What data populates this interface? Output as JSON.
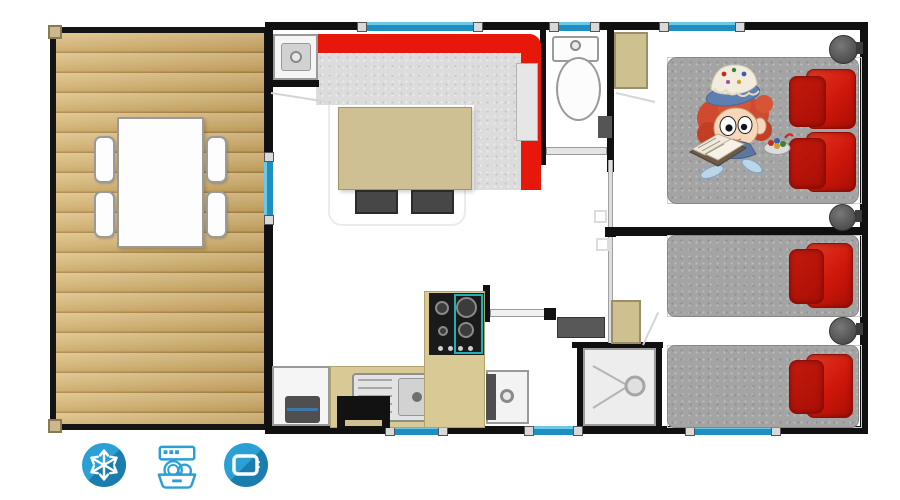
{
  "page": {
    "type": "mobile-home-floor-plan",
    "background": "#ffffff"
  },
  "amenities": [
    {
      "id": "air-conditioning",
      "icon": "snowflake-icon",
      "label": "air conditioning"
    },
    {
      "id": "dishwasher",
      "icon": "dishwasher-icon",
      "label": "dishwasher"
    },
    {
      "id": "television",
      "icon": "tv-icon",
      "label": "television"
    }
  ],
  "palette": {
    "wall": "#101010",
    "window_glass": "#2aa3d6",
    "deck_wood": "#d2b274",
    "sofa_red": "#e8170c",
    "pillow_red": "#c11106",
    "mattress_gray": "#a4a4a4",
    "counter_tan": "#d9c994",
    "wardrobe_tan": "#cfc08f",
    "icon_blue": "#2a9fd6",
    "icon_blue_dark": "#1b7cae"
  },
  "plan": {
    "rooms": [
      "terrace",
      "living-room",
      "kitchen",
      "wc",
      "hallway",
      "entrance",
      "shower-room",
      "bedroom-double",
      "bedroom-twin"
    ],
    "furniture": [
      "dining-table",
      "four-chairs",
      "corner-sofa",
      "coffee-table",
      "two-stools",
      "utility-cabinet",
      "fridge",
      "sink",
      "oven",
      "gas-hob",
      "vanity-unit",
      "toilet",
      "two-wardrobes",
      "shower-tray",
      "bench",
      "double-bed",
      "two-single-beds",
      "three-bedside-tables"
    ],
    "decorations": [
      "cartoon-girl-reading-on-bed",
      "candy-bowl"
    ]
  }
}
